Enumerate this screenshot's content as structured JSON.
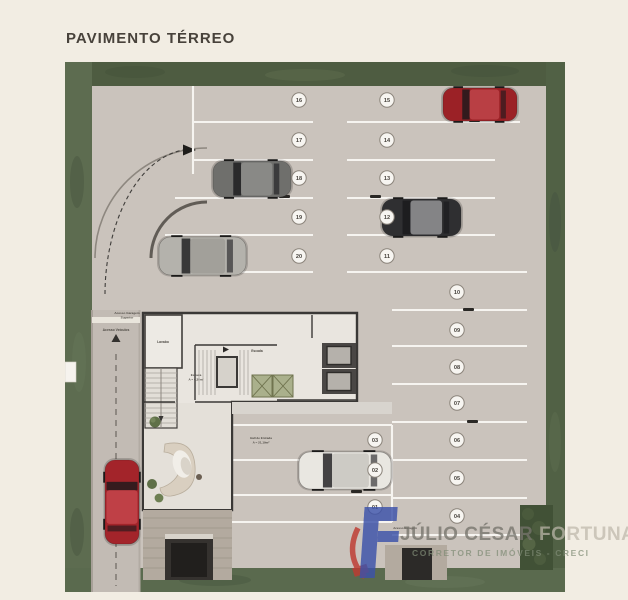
{
  "header": {
    "title": "PAVIMENTO TÉRREO"
  },
  "plan": {
    "labels": {
      "ramp_line1": "Acesso Garagem",
      "ramp_line2": "Superior",
      "vehicle_access": "Acesso Veículos",
      "garage_access": "Acesso Garagem",
      "room_lavabo": "Lavabo",
      "stair_center": "Escada",
      "stair_left_line1": "Escada",
      "stair_left_line2": "A = 4,38m²",
      "hall_line1": "Hall de Entrada",
      "hall_line2": "A = 21,19m²"
    },
    "spots": [
      {
        "id": "01"
      },
      {
        "id": "02"
      },
      {
        "id": "03"
      },
      {
        "id": "04"
      },
      {
        "id": "05"
      },
      {
        "id": "06"
      },
      {
        "id": "07"
      },
      {
        "id": "08"
      },
      {
        "id": "09"
      },
      {
        "id": "10"
      },
      {
        "id": "11"
      },
      {
        "id": "12"
      },
      {
        "id": "13"
      },
      {
        "id": "14"
      },
      {
        "id": "15"
      },
      {
        "id": "16"
      },
      {
        "id": "17"
      },
      {
        "id": "18"
      },
      {
        "id": "19"
      },
      {
        "id": "20"
      }
    ],
    "cars": [
      {
        "name": "car-red-top",
        "color": "#9b2126",
        "roof": 30
      },
      {
        "name": "car-gray-spot18",
        "color": "#6f6f6c",
        "roof": 26
      },
      {
        "name": "car-silver-spot20",
        "color": "#b4b2ac",
        "roof": -18
      },
      {
        "name": "car-black-spot12",
        "color": "#2f2f31",
        "roof": 85
      },
      {
        "name": "car-white-spot02",
        "color": "#e9e7e1",
        "roof": -28
      },
      {
        "name": "car-red-street",
        "color": "#a3242a",
        "roof": 28
      }
    ]
  },
  "watermark": {
    "name_primary": "JÚLIO CÉSAR",
    "name_secondary": " FORTUNA",
    "subtitle": "CORRETOR DE IMÓVEIS - CRECI",
    "logo_blue": "#3c52aa",
    "logo_red": "#bf3a31"
  },
  "colors": {
    "background": "#f2ede3",
    "pavement": "#cac3bc",
    "street": "#c2bbb4",
    "grass_top": "#4e5c41",
    "grass_left": "#5d6c50",
    "grass_right": "#516145",
    "grass_bottom": "#5a6a4e",
    "hedge": "#41513634",
    "stall_line": "#f6f4f0",
    "wall": "#3a3836",
    "core_floor": "#e9e5df",
    "shaft_green": "#aab08c",
    "badge_fill": "#f7f5f1",
    "badge_stroke": "#8b847b",
    "badge_text": "#47433d"
  }
}
